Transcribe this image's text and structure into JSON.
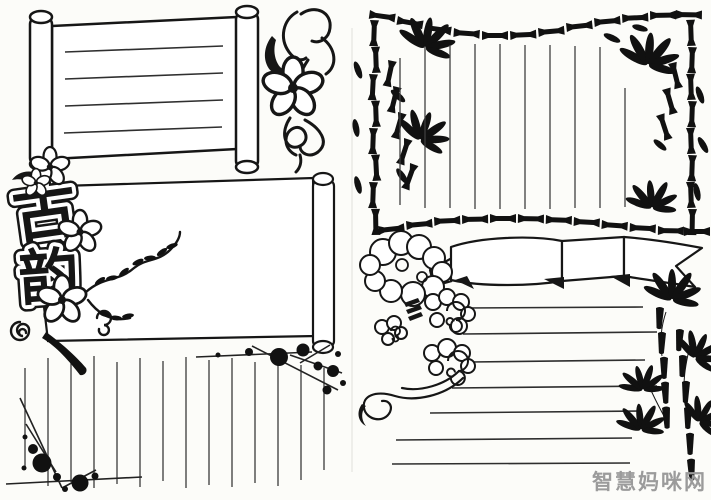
{
  "meta": {
    "description": "Scanned black-ink hand-drawn shouchaobao (handwritten newspaper) template sheet with Chinese classical decorations"
  },
  "title": {
    "text": "古韵",
    "chars": [
      "古",
      "韵"
    ]
  },
  "watermark": {
    "text": "智慧妈咪网",
    "color": "#9b9b9b"
  },
  "colors": {
    "ink": "#161616",
    "paper": "#fcfcf9",
    "rule_line": "#3a3a3a",
    "watermark": "#9b9b9b"
  },
  "panels": [
    {
      "id": "top-left-scroll",
      "type": "horizontal-scroll-with-rollers",
      "ruled_lines": 4
    },
    {
      "id": "middle-left-scroll",
      "type": "horizontal-scroll-with-right-roller",
      "ruled_lines": 0
    },
    {
      "id": "bottom-left-vertical-ruled",
      "type": "vertical-ruled-area",
      "ruled_lines": 14
    },
    {
      "id": "top-right-bamboo-frame",
      "type": "bamboo-border-frame",
      "ruled_lines": 10
    },
    {
      "id": "right-ribbon-banner",
      "type": "ribbon-banner",
      "ruled_lines": 0
    },
    {
      "id": "bottom-right-horizontal-ruled",
      "type": "horizontal-ruled-area",
      "ruled_lines": 7
    }
  ],
  "decorations": [
    "scroll-rollers",
    "flower-vine",
    "plum-blossoms",
    "calligraphy-title",
    "ink-splatter-branches",
    "bamboo-silhouette-border",
    "auspicious-clouds",
    "ribbon-banner",
    "bamboo-plant"
  ]
}
